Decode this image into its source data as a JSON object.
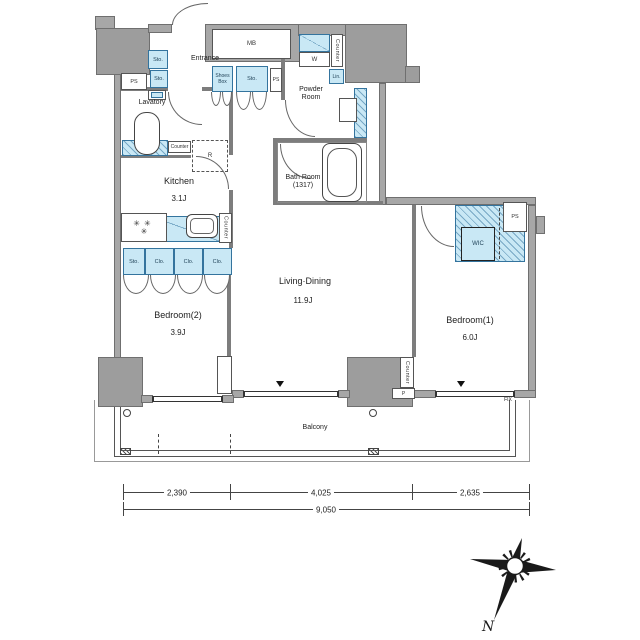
{
  "plan_type": "apartment-floor-plan",
  "rooms": {
    "entrance": "Entrance",
    "lavatory": "Lavatory",
    "kitchen": "Kitchen",
    "kitchen_size": "3.1J",
    "powder1": "Powder",
    "powder2": "Room",
    "bath1": "Bath Room",
    "bath2": "(1317)",
    "living": "Living·Dining",
    "living_size": "11.9J",
    "bedroom2": "Bedroom(2)",
    "bedroom2_size": "3.9J",
    "bedroom1": "Bedroom(1)",
    "bedroom1_size": "6.0J",
    "balcony": "Balcony"
  },
  "fix": {
    "mb": "MB",
    "sto": "Sto.",
    "shoes1": "Shoes",
    "shoes2": "Box",
    "ps": "PS",
    "counter": "Counter",
    "r": "R",
    "w": "W",
    "lin": "Lin.",
    "wic": "WIC",
    "clo": "Clo.",
    "p": "P",
    "fix": "FIX"
  },
  "dims": {
    "s1": "2,390",
    "s2": "4,025",
    "s3": "2,635",
    "total": "9,050"
  },
  "compass": {
    "n": "N"
  },
  "colors": {
    "wall": "#a7a7a7",
    "fixture_fill": "#c9e8f5",
    "fixture_border": "#34749e"
  }
}
